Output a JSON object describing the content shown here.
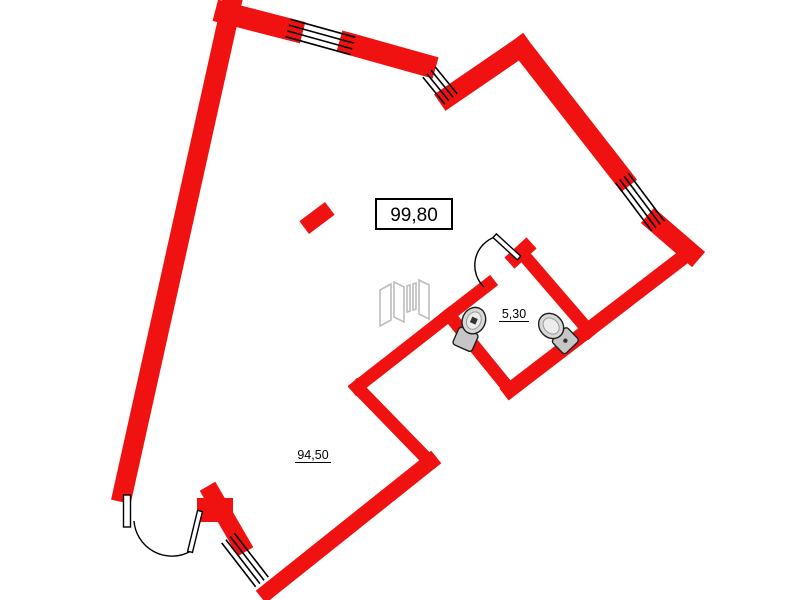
{
  "plan": {
    "kind": "apartment-floor-plan",
    "labels": {
      "total_area": "99,80",
      "main_room_area": "94,50",
      "bathroom_area": "5,30"
    },
    "rooms": [
      {
        "name": "main-room",
        "area_label": "94,50"
      },
      {
        "name": "bathroom",
        "area_label": "5,30"
      }
    ],
    "openings": {
      "windows": 4,
      "doors": 2
    },
    "fixtures": [
      {
        "name": "toilet-icon",
        "count": 2
      },
      {
        "name": "folding-screen-icon",
        "count": 1
      },
      {
        "name": "column",
        "count": 1
      }
    ]
  },
  "colors": {
    "wall_red": "#f01111",
    "outline_black": "#000000",
    "fixture_gray": "#d8d8d8",
    "fixture_gray_dark": "#c6c6c6",
    "screen_gray": "#bdbdbd",
    "background": "#ffffff"
  }
}
